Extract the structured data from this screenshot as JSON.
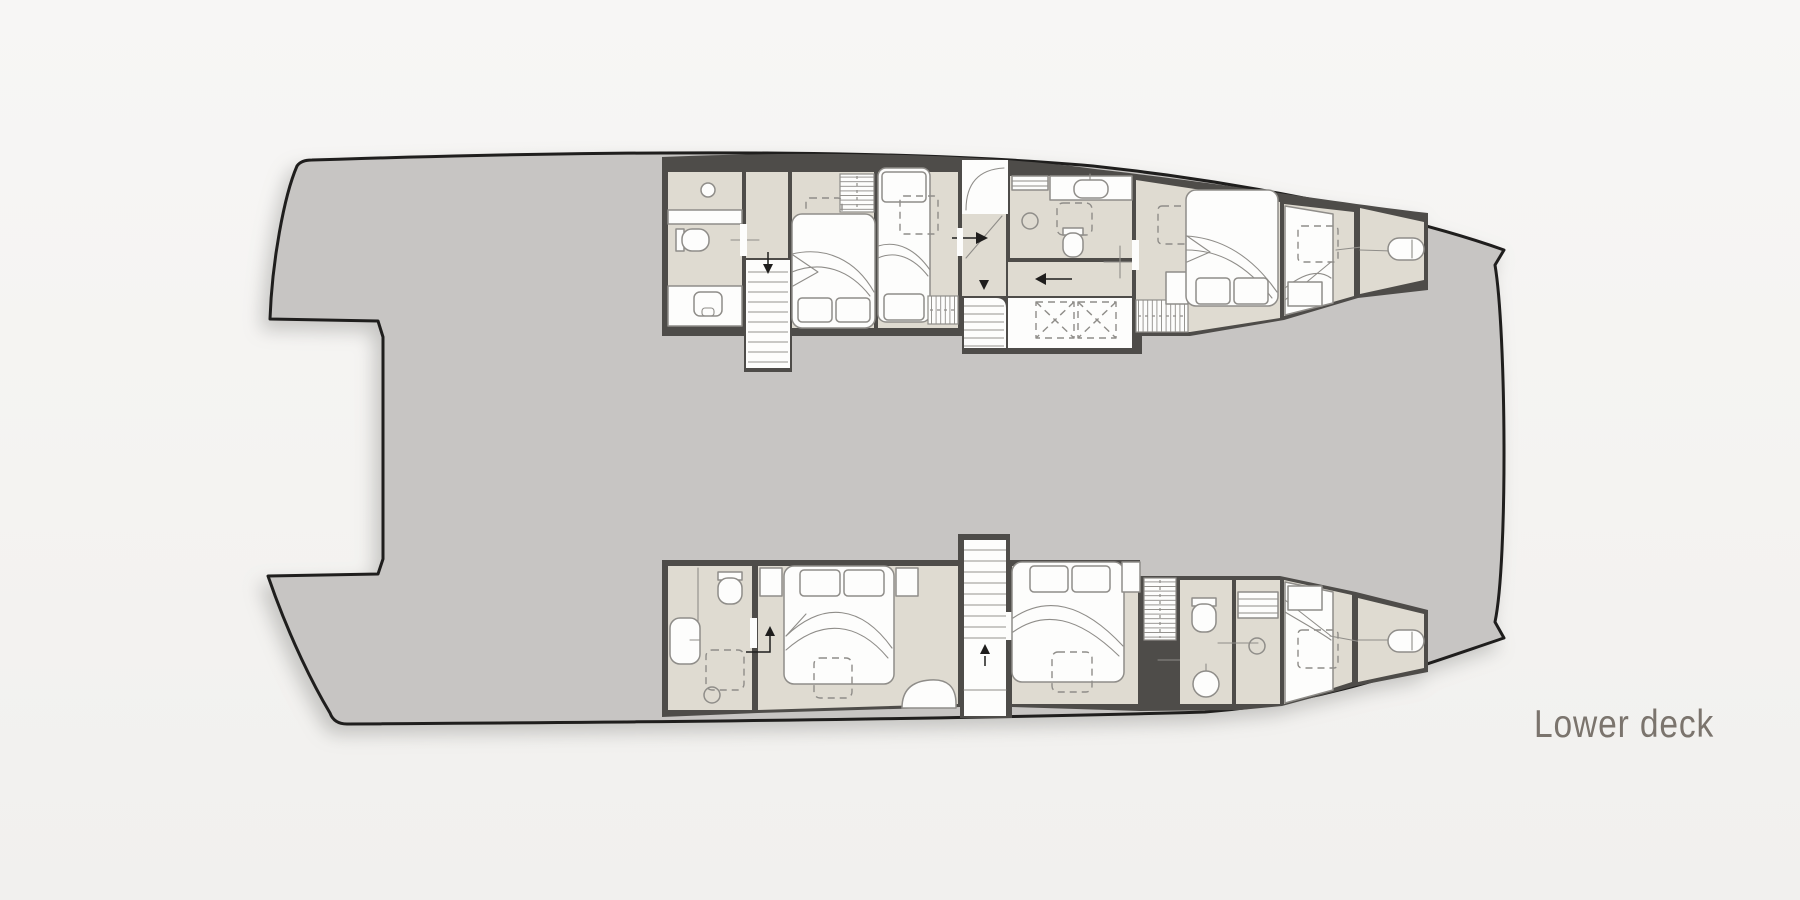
{
  "page": {
    "background_top": "#f7f6f5",
    "background_bottom": "#f1f0ee"
  },
  "plan": {
    "label": "Lower deck",
    "vessel": "catamaran floor plan, plan view, bow to the right",
    "colors": {
      "deck": "#c7c5c3",
      "outline": "#1f1e1d",
      "wall": "#4e4c49",
      "floor": "#dfdbd1",
      "paper": "#fdfdfc",
      "furn": "#8f8d89",
      "tread": "#aaa8a4",
      "ink": "#1f1e1d",
      "label_color": "#7b746d",
      "bg_top": "#f7f6f5",
      "bg_bottom": "#f1f0ee"
    },
    "hulls": {
      "port": {
        "position": "top",
        "rooms": [
          "aft bathroom",
          "aft staircase",
          "aft double cabin",
          "guest berth cabin",
          "midship bathroom",
          "companionway",
          "midship staircase",
          "storage lockers",
          "hanging wardrobe",
          "VIP double cabin",
          "forward berth cabin",
          "forward locker room"
        ]
      },
      "starboard": {
        "position": "bottom",
        "rooms": [
          "aft bathroom",
          "aft double cabin",
          "midship staircase",
          "double cabin",
          "hanging wardrobe",
          "bathroom",
          "shower room",
          "forward berth cabin",
          "forward locker room"
        ]
      }
    }
  }
}
